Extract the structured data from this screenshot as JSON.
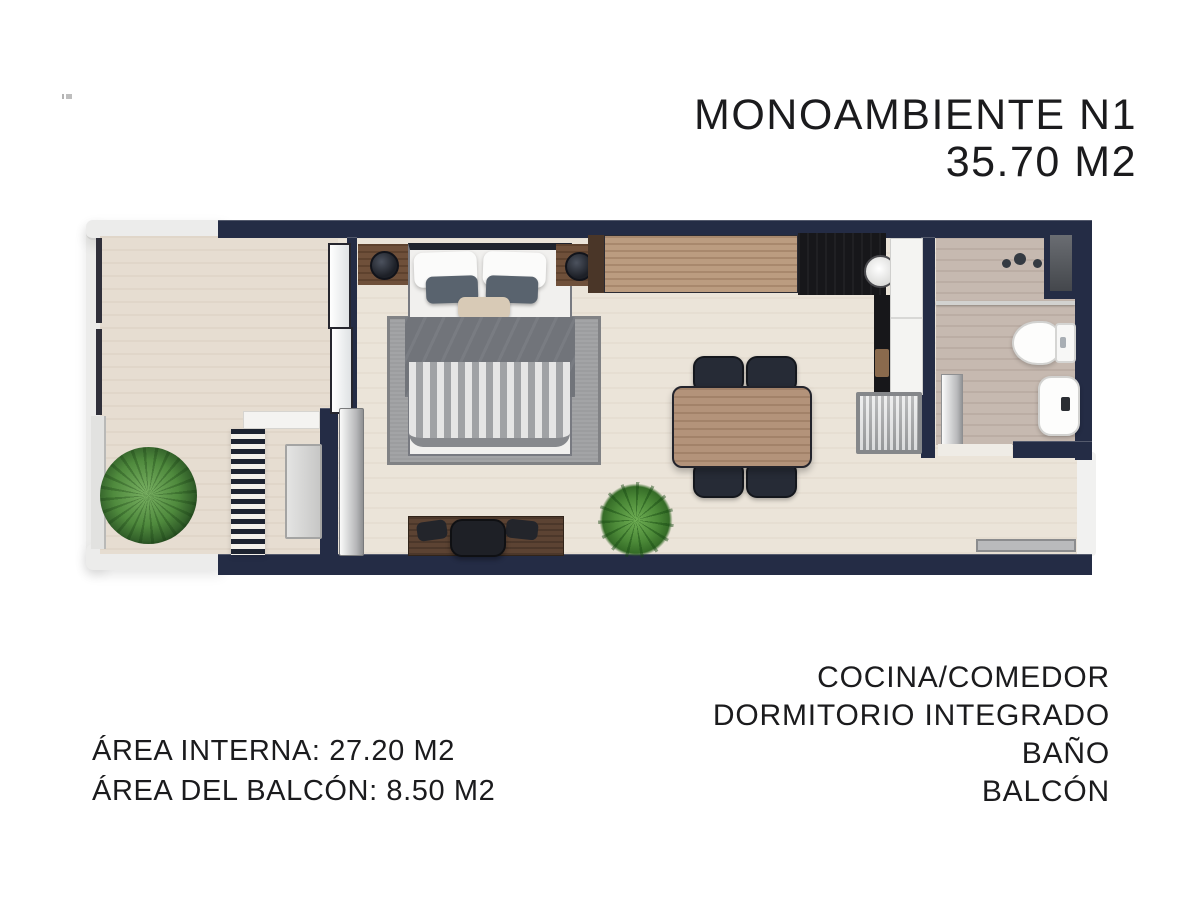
{
  "header": {
    "title_line1": "MONOAMBIENTE N1",
    "title_line2": "35.70 M2"
  },
  "areas": {
    "line1": "ÁREA INTERNA: 27.20 M2",
    "line2": "ÁREA DEL BALCÓN: 8.50 M2"
  },
  "rooms": [
    "COCINA/COMEDOR",
    "DORMITORIO INTEGRADO",
    "BAÑO",
    "BALCÓN"
  ],
  "floor_plan": {
    "unit_name": "MONOAMBIENTE N1",
    "total_area_m2": "35.70",
    "internal_area_m2": "27.20",
    "balcony_area_m2": "8.50",
    "colors": {
      "wall_navy": "#242c45",
      "floor_living": "#ebe4d9",
      "floor_balcony": "#e6ddd1",
      "floor_bathroom": "#c6b9b0",
      "wood_light": "#bb9c80",
      "wood_dark": "#5c4333",
      "counter_black": "#17171a",
      "rug_gray": "#9c9d9f",
      "plant_green": "#4f8a3d",
      "text": "#1b1b1d"
    },
    "elements": [
      "balcony",
      "balcony-plant",
      "balcony-ladder",
      "balcony-bench",
      "sliding-glass-door",
      "double-bed",
      "area-rug",
      "nightstand-left",
      "nightstand-right",
      "bedside-lamps",
      "desk-with-chair",
      "kitchen-counter",
      "black-countertop",
      "round-sink",
      "tall-cabinet",
      "washing-machine",
      "dining-table",
      "four-chairs",
      "indoor-plant",
      "bathroom",
      "shower",
      "bathroom-window",
      "toilet",
      "bidet",
      "bathroom-door",
      "entry-doormat"
    ]
  }
}
